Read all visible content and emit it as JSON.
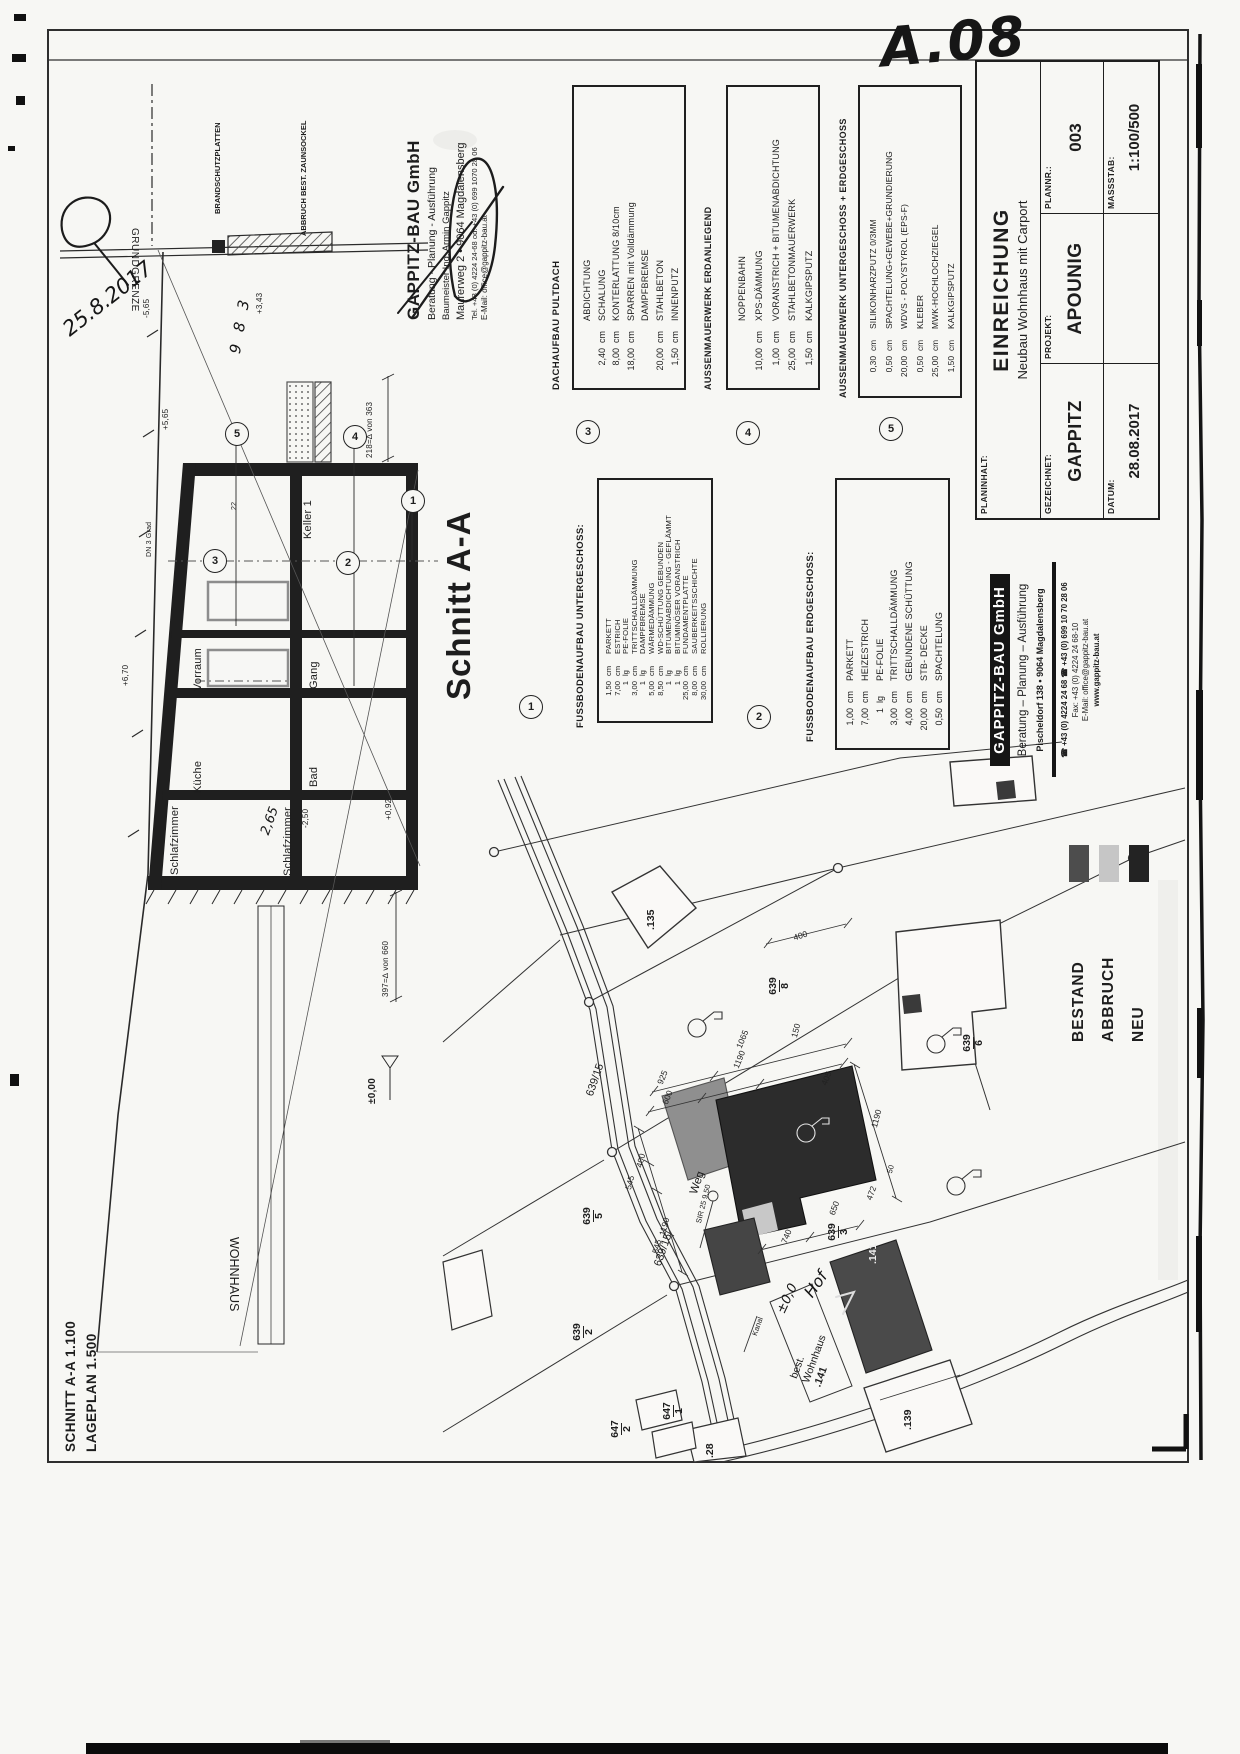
{
  "sheet": {
    "code": "A.08",
    "hand_date": "25.8.2017",
    "hand_mark": "9 8 3"
  },
  "title_block": {
    "planinhalt_label": "PLANINHALT:",
    "planinhalt_value": "EINREICHUNG",
    "planinhalt_sub": "Neubau Wohnhaus mit Carport",
    "gezeichnet_label": "GEZEICHNET:",
    "gezeichnet_value": "GAPPITZ",
    "projekt_label": "PROJEKT:",
    "projekt_value": "APOUNIG",
    "plannr_label": "PLANNR.:",
    "plannr_value": "003",
    "datum_label": "DATUM:",
    "datum_value": "28.08.2017",
    "massstab_label": "MASSSTAB:",
    "massstab_value": "1:100/500"
  },
  "company_top": {
    "name": "GAPPITZ-BAU GmbH",
    "line1": "Beratung - Planung - Ausführung",
    "line2": "Baumeister Ing. Armin Gappitz",
    "line3": "Maurerweg 2 • 9064 Magdalensberg",
    "line4": "Tel. +43 (0) 4224 24-68 od. +43 (0) 699 1070 28 06",
    "line5": "E-Mail: office@gappitz-bau.at"
  },
  "company_side": {
    "name": "GAPPITZ-BAU GmbH",
    "line1": "Beratung  –  Planung  –  Ausführung",
    "line2": "Pischeldorf 138  •  9064 Magdalensberg",
    "line3": "☎ +43 (0) 4224 24 68  ☎ +43 (0) 699 10 70 28 06",
    "line4": "Fax: +43 (0) 4224 24 68-10",
    "line5": "E-Mail: office@gappitz-bau.at",
    "line6": "www.gappitz-bau.at"
  },
  "legend": {
    "items": [
      {
        "label": "BESTAND",
        "color": "#4d4d4d"
      },
      {
        "label": "ABBRUCH",
        "color": "#c6c6c6"
      },
      {
        "label": "NEU",
        "color": "#232323"
      }
    ]
  },
  "spec_boxes": [
    {
      "num": "1",
      "heading": "FUSSBODENAUFBAU UNTERGESCHOSS:",
      "items": [
        {
          "v": "1,50",
          "u": "cm",
          "n": "PARKETT"
        },
        {
          "v": "7,00",
          "u": "cm",
          "n": "ESTRICH"
        },
        {
          "v": "1",
          "u": "lg",
          "n": "PE-FOLIE"
        },
        {
          "v": "3,00",
          "u": "cm",
          "n": "TRITTSCHALLDÄMMUNG"
        },
        {
          "v": "1",
          "u": "lg",
          "n": "DAMPFBREMSE"
        },
        {
          "v": "5,00",
          "u": "cm",
          "n": "WÄRMEDÄMMUNG"
        },
        {
          "v": "8,50",
          "u": "cm",
          "n": "WD-SCHÜTTUNG GEBUNDEN"
        },
        {
          "v": "1",
          "u": "lg",
          "n": "BITUMENABDICHTUNG - GEFLÄMMT"
        },
        {
          "v": "1",
          "u": "lg",
          "n": "BITUMINÖSER VORANSTRICH"
        },
        {
          "v": "25,00",
          "u": "cm",
          "n": "FUNDAMENTPLATTE"
        },
        {
          "v": "8,00",
          "u": "cm",
          "n": "SAUBERKEITSSCHICHTE"
        },
        {
          "v": "30,00",
          "u": "cm",
          "n": "ROLLIERUNG"
        }
      ]
    },
    {
      "num": "2",
      "heading": "FUSSBODENAUFBAU ERDGESCHOSS:",
      "items": [
        {
          "v": "1,00",
          "u": "cm",
          "n": "PARKETT"
        },
        {
          "v": "7,00",
          "u": "cm",
          "n": "HEIZESTRICH"
        },
        {
          "v": "1",
          "u": "lg",
          "n": "PE-FOLIE"
        },
        {
          "v": "3,00",
          "u": "cm",
          "n": "TRITTSCHALLDÄMMUNG"
        },
        {
          "v": "4,00",
          "u": "cm",
          "n": "GEBUNDENE SCHÜTTUNG"
        },
        {
          "v": "20,00",
          "u": "cm",
          "n": "STB- DECKE"
        },
        {
          "v": "0,50",
          "u": "cm",
          "n": "SPACHTELUNG"
        }
      ]
    },
    {
      "num": "3",
      "heading": "DACHAUFBAU PULTDACH",
      "items": [
        {
          "v": "",
          "u": "",
          "n": "ABDICHTUNG"
        },
        {
          "v": "2,40",
          "u": "cm",
          "n": "SCHALUNG"
        },
        {
          "v": "8,00",
          "u": "cm",
          "n": "KONTERLATTUNG 8/10cm"
        },
        {
          "v": "18,00",
          "u": "cm",
          "n": "SPARREN  mit  Volldämmung"
        },
        {
          "v": "",
          "u": "",
          "n": "DAMPFBREMSE"
        },
        {
          "v": "20,00",
          "u": "cm",
          "n": "STAHLBETON"
        },
        {
          "v": "1,50",
          "u": "cm",
          "n": "INNENPUTZ"
        }
      ]
    },
    {
      "num": "4",
      "heading": "AUSSENMAUERWERK ERDANLIEGEND",
      "items": [
        {
          "v": "",
          "u": "",
          "n": "NOPPENBAHN"
        },
        {
          "v": "10,00",
          "u": "cm",
          "n": "XPS-DÄMMUNG"
        },
        {
          "v": "1,00",
          "u": "cm",
          "n": "VORANSTRICH + BITUMENABDICHTUNG"
        },
        {
          "v": "25,00",
          "u": "cm",
          "n": "STAHLBETONMAUERWERK"
        },
        {
          "v": "1,50",
          "u": "cm",
          "n": "KALKGIPSPUTZ"
        }
      ]
    },
    {
      "num": "5",
      "heading": "AUSSENMAUERWERK UNTERGESCHOSS + ERDGESCHOSS",
      "items": [
        {
          "v": "0,30",
          "u": "cm",
          "n": "SILIKONHARZPUTZ 0/3MM"
        },
        {
          "v": "0,50",
          "u": "cm",
          "n": "SPACHTELUNG+GEWEBE+GRUNDIERUNG"
        },
        {
          "v": "20,00",
          "u": "cm",
          "n": "WDVS - POLYSTYROL (EPS-F)"
        },
        {
          "v": "0,50",
          "u": "cm",
          "n": "KLEBER"
        },
        {
          "v": "25,00",
          "u": "cm",
          "n": "MWK-HOCHLOCHZIEGEL"
        },
        {
          "v": "1,50",
          "u": "cm",
          "n": "KALKGIPSPUTZ"
        }
      ]
    }
  ],
  "section": {
    "title": "Schnitt A-A",
    "rooms": [
      "Keller 1",
      "Vorraum",
      "Gang",
      "Küche",
      "Bad",
      "Schlafzimmer",
      "Schlafzimmer"
    ],
    "wohnhaus": "WOHNHAUS",
    "grundgrenze": "GRUNDGRENZE",
    "brandschutz": "BRANDSCHUTZPLATTEN",
    "abbruch_zaun": "ABBRUCH BEST. ZAUNSOCKEL",
    "markers": [
      "1",
      "2",
      "3",
      "4",
      "5"
    ],
    "notes": [
      "+5,65",
      "-5,65",
      "DN 3 Grad",
      "+6,70",
      "218=∆ von 363",
      "397=∆ von 660",
      "±0,00",
      "+3,43",
      "22",
      "2,65",
      "-2,50",
      "+0,92"
    ]
  },
  "siteplan": {
    "road_labels": [
      "639/15",
      "639/15",
      "Weg"
    ],
    "parcels": [
      {
        "n": "639",
        "d": "8"
      },
      {
        "n": "639",
        "d": "5"
      },
      {
        "n": "639",
        "d": "2"
      },
      {
        "n": "639",
        "d": "3"
      },
      {
        "n": "639",
        "d": "6"
      },
      {
        "n": "647",
        "d": "1"
      },
      {
        "n": "647",
        "d": "2"
      }
    ],
    "buildings": [
      ".135",
      ".141",
      ".139",
      ".28"
    ],
    "house_label": {
      "l1": "best.",
      "l2": "Wohnhaus",
      "l3": ".141"
    },
    "small_labels": [
      "Kanal",
      "SIR 25 9,50"
    ],
    "hand_labels": [
      "Hof",
      "±0,0"
    ],
    "dims": [
      "600",
      "925",
      "1065",
      "1190",
      "150",
      "405",
      "400",
      "545",
      "1190",
      "545",
      "740",
      "650",
      "472",
      "1190",
      "50",
      "400"
    ]
  },
  "corner_note": {
    "line1": "SCHNITT A-A 1.100",
    "line2": "LAGEPLAN 1.500"
  }
}
